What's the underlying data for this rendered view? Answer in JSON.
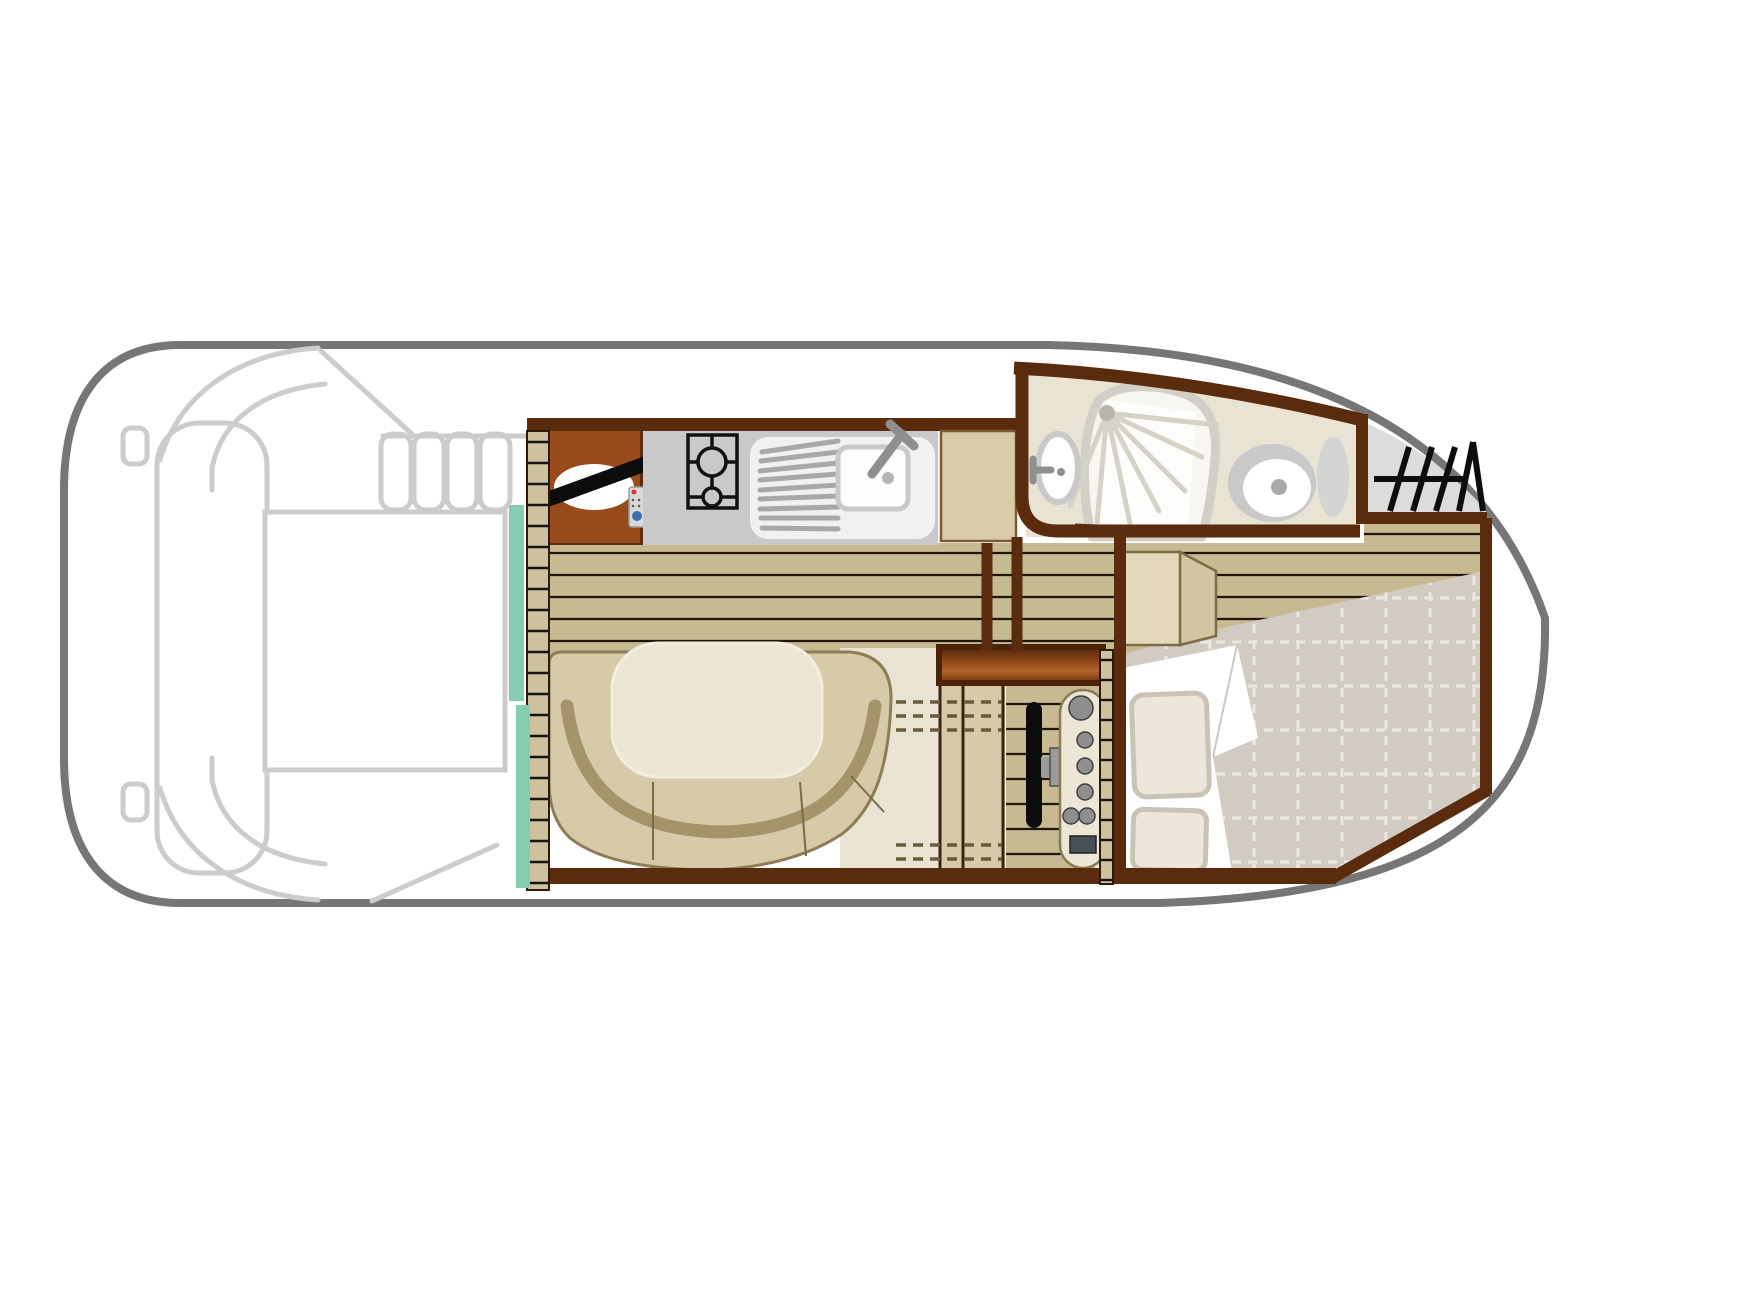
{
  "figure": {
    "type": "boat-deck-floor-plan",
    "orientation": "bow-right",
    "areas": [
      "aft-deck",
      "entry-steps",
      "galley",
      "saloon",
      "bathroom",
      "anchor-locker",
      "helm-station",
      "bow-cabin"
    ],
    "fixtures": [
      "tv-on-cabinet",
      "remote-control",
      "two-burner-stove",
      "sink-with-drainer",
      "fridge-top",
      "dinette-table",
      "u-shaped-sofa",
      "washbasin",
      "shower",
      "toilet",
      "wardrobe",
      "steering-wheel",
      "instrument-panel",
      "double-bed",
      "pillows",
      "duvet"
    ]
  },
  "palette": {
    "hull": "#767676",
    "deckLine": "#cccccc",
    "wall": "#5a2b0d",
    "cabinetWood": "#9a4b1b",
    "cupboardTop": "#8a4517",
    "counterGray": "#c9c9c9",
    "sinkWhite": "#f1f1f1",
    "applianceOutline": "#111111",
    "fridgeBeige": "#d9cba8",
    "floorPlank": "#c7b991",
    "plankLine": "#20150b",
    "ladderTan": "#cdc19e",
    "windowTeal": "#85ccb1",
    "sofaTan": "#d7caa9",
    "sofaOutline": "#8d7c54",
    "sofaBand": "#a5936a",
    "tableCream": "#ece6d4",
    "bathFloorCream": "#e9e3d3",
    "fixtureGray": "#c9c9c9",
    "sprayGray": "#d6d2c7",
    "metalGray": "#8f8f8f",
    "lockerGray": "#dcdcdc",
    "hatchBlack": "#0d0d0d",
    "mattressQuilt": "#d2cbc4",
    "quiltSeam": "#ebe8e4",
    "duvetWhite": "#ffffff",
    "pillowCream": "#ece7da",
    "pillowShadow": "#c9c3b6",
    "steeringBlack": "#0b0b0b",
    "dashPanel": "#ece6d6",
    "tvRemoteGray": "#d9d9d9"
  }
}
